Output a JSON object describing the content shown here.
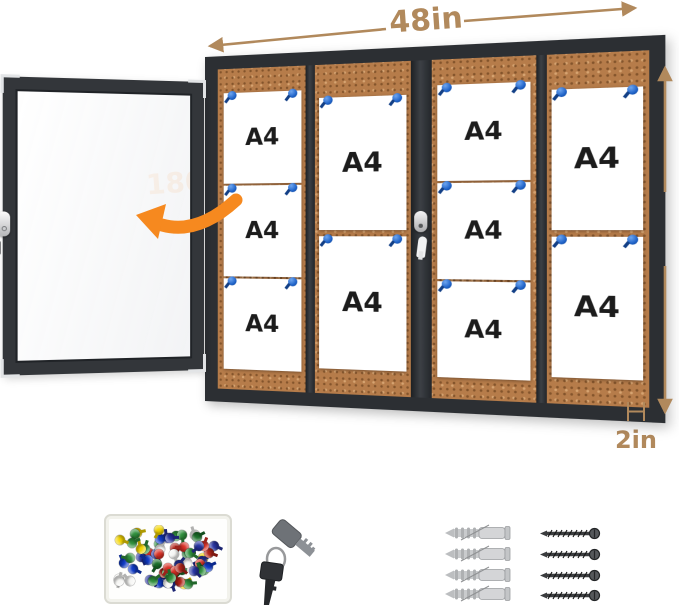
{
  "annotations": {
    "width_label": "48in",
    "height_label": "30in",
    "depth_label": "2in",
    "door_swing_label": "180°"
  },
  "board": {
    "sheet_label": "A4",
    "sheet_count": 10,
    "columns": [
      {
        "sheets": 3
      },
      {
        "sheets": 2
      },
      {
        "sheets": 3
      },
      {
        "sheets": 2
      }
    ],
    "pins_per_sheet": 2
  },
  "colors": {
    "dimension_tan": "#b1895c",
    "accent_orange": "#f6891f",
    "frame_dark": "#2c2f33",
    "cork": "#b67c4a",
    "pin_blue": "#1e62c8"
  },
  "accessories": {
    "items": [
      "push-pin-box",
      "keys",
      "adhesive-pad",
      "wall-anchors",
      "screws"
    ],
    "pushpin_colors": [
      "#d93025",
      "#27339f",
      "#2f8f3c",
      "#f2d400",
      "#f6f6f4",
      "#103ac4",
      "#b02318",
      "#1b6e2a"
    ],
    "loose_pin_count": 66,
    "key_count": 2,
    "wall_anchor_count": 4,
    "screw_count": 4
  }
}
